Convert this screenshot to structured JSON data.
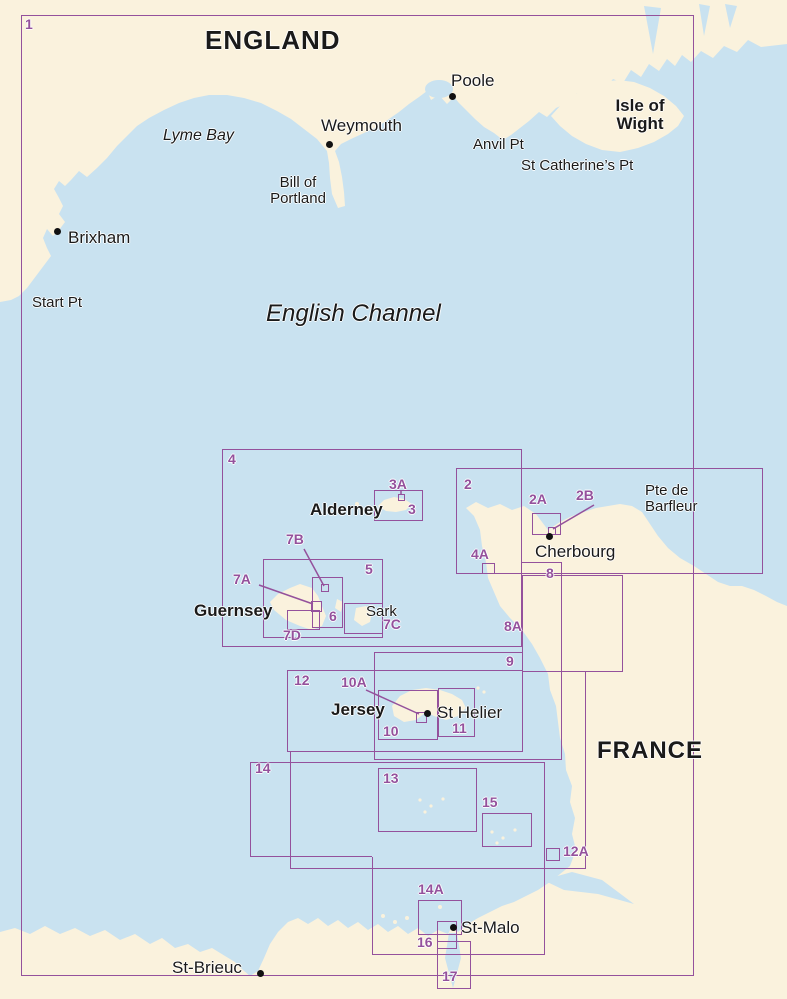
{
  "regions": {
    "england": "ENGLAND",
    "france": "FRANCE"
  },
  "water": {
    "english_channel": "English Channel",
    "lyme_bay": "Lyme Bay"
  },
  "places": {
    "poole": "Poole",
    "weymouth": "Weymouth",
    "brixham": "Brixham",
    "start_pt": "Start Pt",
    "anvil_pt": "Anvil Pt",
    "st_catherines_pt": "St Catherine’s Pt",
    "bill_of_portland": "Bill of\nPortland",
    "isle_of_wight": "Isle of\nWight",
    "cherbourg": "Cherbourg",
    "pte_de_barfleur": "Pte de\nBarfleur",
    "alderney": "Alderney",
    "guernsey": "Guernsey",
    "sark": "Sark",
    "jersey": "Jersey",
    "st_helier": "St Helier",
    "st_malo": "St-Malo",
    "st_brieuc": "St-Brieuc"
  },
  "charts": {
    "c1": "1",
    "c2": "2",
    "c2a": "2A",
    "c2b": "2B",
    "c3": "3",
    "c3a": "3A",
    "c4": "4",
    "c4a": "4A",
    "c5": "5",
    "c6": "6",
    "c7a": "7A",
    "c7b": "7B",
    "c7c": "7C",
    "c7d": "7D",
    "c8": "8",
    "c8a": "8A",
    "c9": "9",
    "c10": "10",
    "c10a": "10A",
    "c11": "11",
    "c12": "12",
    "c12a": "12A",
    "c13": "13",
    "c14": "14",
    "c14a": "14A",
    "c15": "15",
    "c16": "16",
    "c17": "17"
  },
  "colors": {
    "sea": "#c9e2f0",
    "land": "#faf2dd",
    "chart_outline": "#94519c",
    "text": "#1a1a1a"
  }
}
